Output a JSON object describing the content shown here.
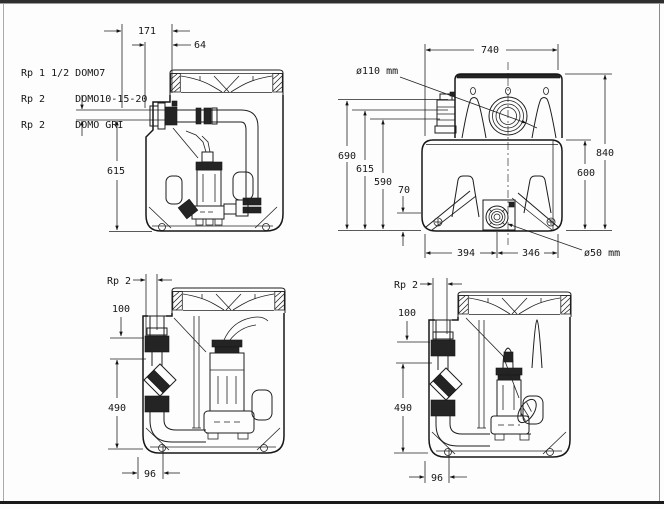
{
  "labels": {
    "models": [
      "Rp 1 1/2 DOMO7",
      "Rp 2     DOMO10-15-20",
      "Rp 2     DOMO GRI"
    ]
  },
  "views": {
    "top_left_side": {
      "dim_offset_total": "171",
      "dim_offset_small": "64",
      "dim_height": "615"
    },
    "top_right_front": {
      "dim_width": "740",
      "label_inlet_diameter": "ø110 mm",
      "dim_h_inlet_top": "690",
      "dim_h_mid": "615",
      "dim_h_low": "590",
      "dim_h_base": "70",
      "dim_total_height": "840",
      "dim_body_height": "600",
      "dim_bottom_left": "394",
      "dim_bottom_right": "346",
      "label_drain_diameter": "ø50 mm"
    },
    "bottom_left_side": {
      "label_port": "Rp 2",
      "dim_top": "100",
      "dim_height": "490",
      "dim_offset": "96"
    },
    "bottom_right_side": {
      "label_port": "Rp 2",
      "dim_top": "100",
      "dim_height": "490",
      "dim_offset": "96"
    }
  }
}
